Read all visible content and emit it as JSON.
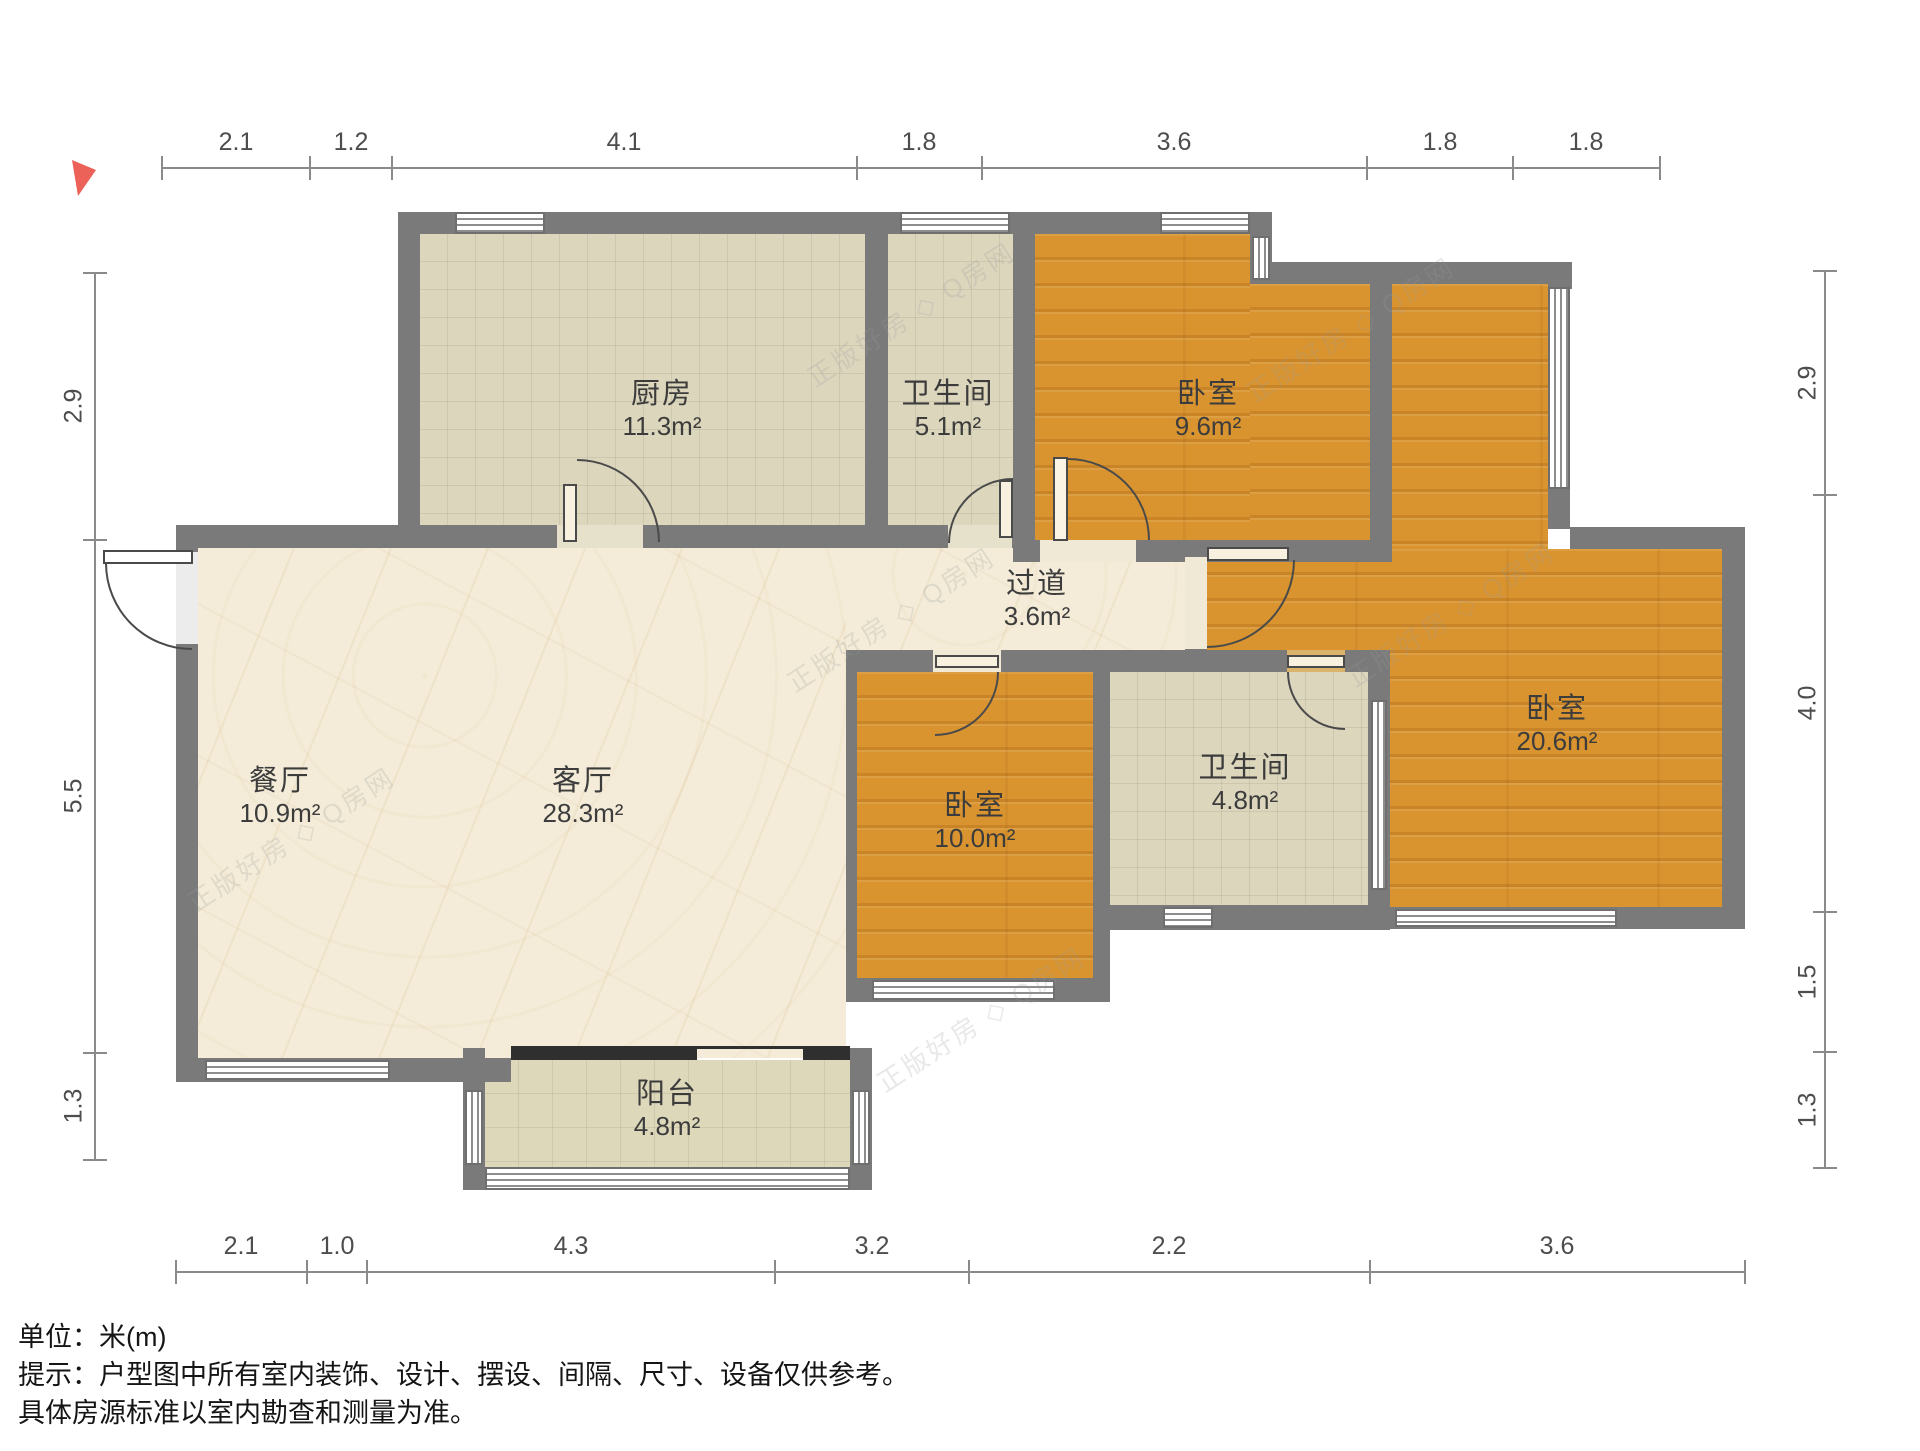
{
  "meta": {
    "unit_label": "单位：米(m)",
    "note_line1": "提示：户型图中所有室内装饰、设计、摆设、间隔、尺寸、设备仅供参考。",
    "note_line2": "具体房源标准以室内勘查和测量为准。"
  },
  "watermark": {
    "brand": "正版好房",
    "mark": "◇",
    "site": "Q房网"
  },
  "colors": {
    "wall": "#7a7a7a",
    "wood": "#d9942f",
    "tile": "#dcd6bd",
    "marble": "#f4ecd9",
    "balcony": "#ded8ba",
    "band": "#2f2f2f",
    "arrow": "#ec6158"
  },
  "rooms": {
    "kitchen": {
      "name": "厨房",
      "area": "11.3m²"
    },
    "bath_top": {
      "name": "卫生间",
      "area": "5.1m²"
    },
    "bedroom_top": {
      "name": "卧室",
      "area": "9.6m²"
    },
    "hallway": {
      "name": "过道",
      "area": "3.6m²"
    },
    "dining": {
      "name": "餐厅",
      "area": "10.9m²"
    },
    "living": {
      "name": "客厅",
      "area": "28.3m²"
    },
    "bedroom_mid": {
      "name": "卧室",
      "area": "10.0m²"
    },
    "bath_mid": {
      "name": "卫生间",
      "area": "4.8m²"
    },
    "bedroom_right": {
      "name": "卧室",
      "area": "20.6m²"
    },
    "balcony": {
      "name": "阳台",
      "area": "4.8m²"
    }
  },
  "dimensions": {
    "top": [
      "2.1",
      "1.2",
      "4.1",
      "1.8",
      "3.6",
      "1.8",
      "1.8"
    ],
    "bottom": [
      "2.1",
      "1.0",
      "4.3",
      "3.2",
      "2.2",
      "3.6"
    ],
    "left": [
      "2.9",
      "5.5",
      "1.3"
    ],
    "right": [
      "2.9",
      "4.0",
      "1.5",
      "1.3"
    ]
  }
}
